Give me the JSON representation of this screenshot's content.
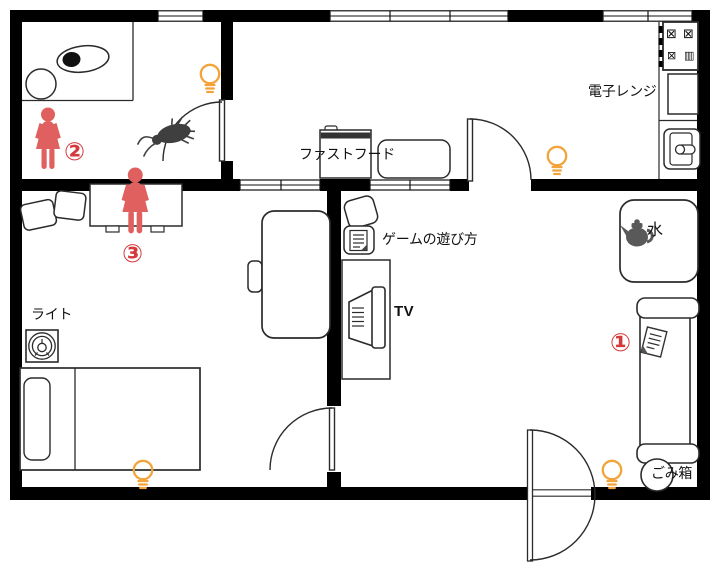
{
  "labels": {
    "microwave": "電子レンジ",
    "fast_food": "ファストフード",
    "game_guide": "ゲームの遊び方",
    "tv": "TV",
    "water": "水",
    "light": "ライト",
    "trash_bin": "ごみ箱"
  },
  "markers": {
    "one": "①",
    "two": "②",
    "three": "③"
  },
  "stove": {
    "burners": [
      "⊠",
      "⊠",
      "⊠",
      "▥"
    ]
  },
  "colors": {
    "wall": "#000000",
    "person": "#e06060",
    "marker_red": "#d4393b",
    "bulb_orange": "#f2a43b",
    "bug_gray": "#3f3f3f",
    "kettle_gray": "#595959",
    "line": "#2b2b2b"
  },
  "icons": {
    "light_bulb": "outline light bulb (4 places)",
    "female_person": "red female figure (2 places)",
    "cockroach": "dark cockroach near inner door",
    "kettle": "dark kettle on low table",
    "tv": "television on TV stand",
    "paper_note": "tilted note on sofa",
    "game_manual": "document sheet in box",
    "ceiling_light": "concentric-circle light fixture",
    "toilet": "toilet top view with round sink",
    "trash_can": "round trash can by sofa"
  }
}
